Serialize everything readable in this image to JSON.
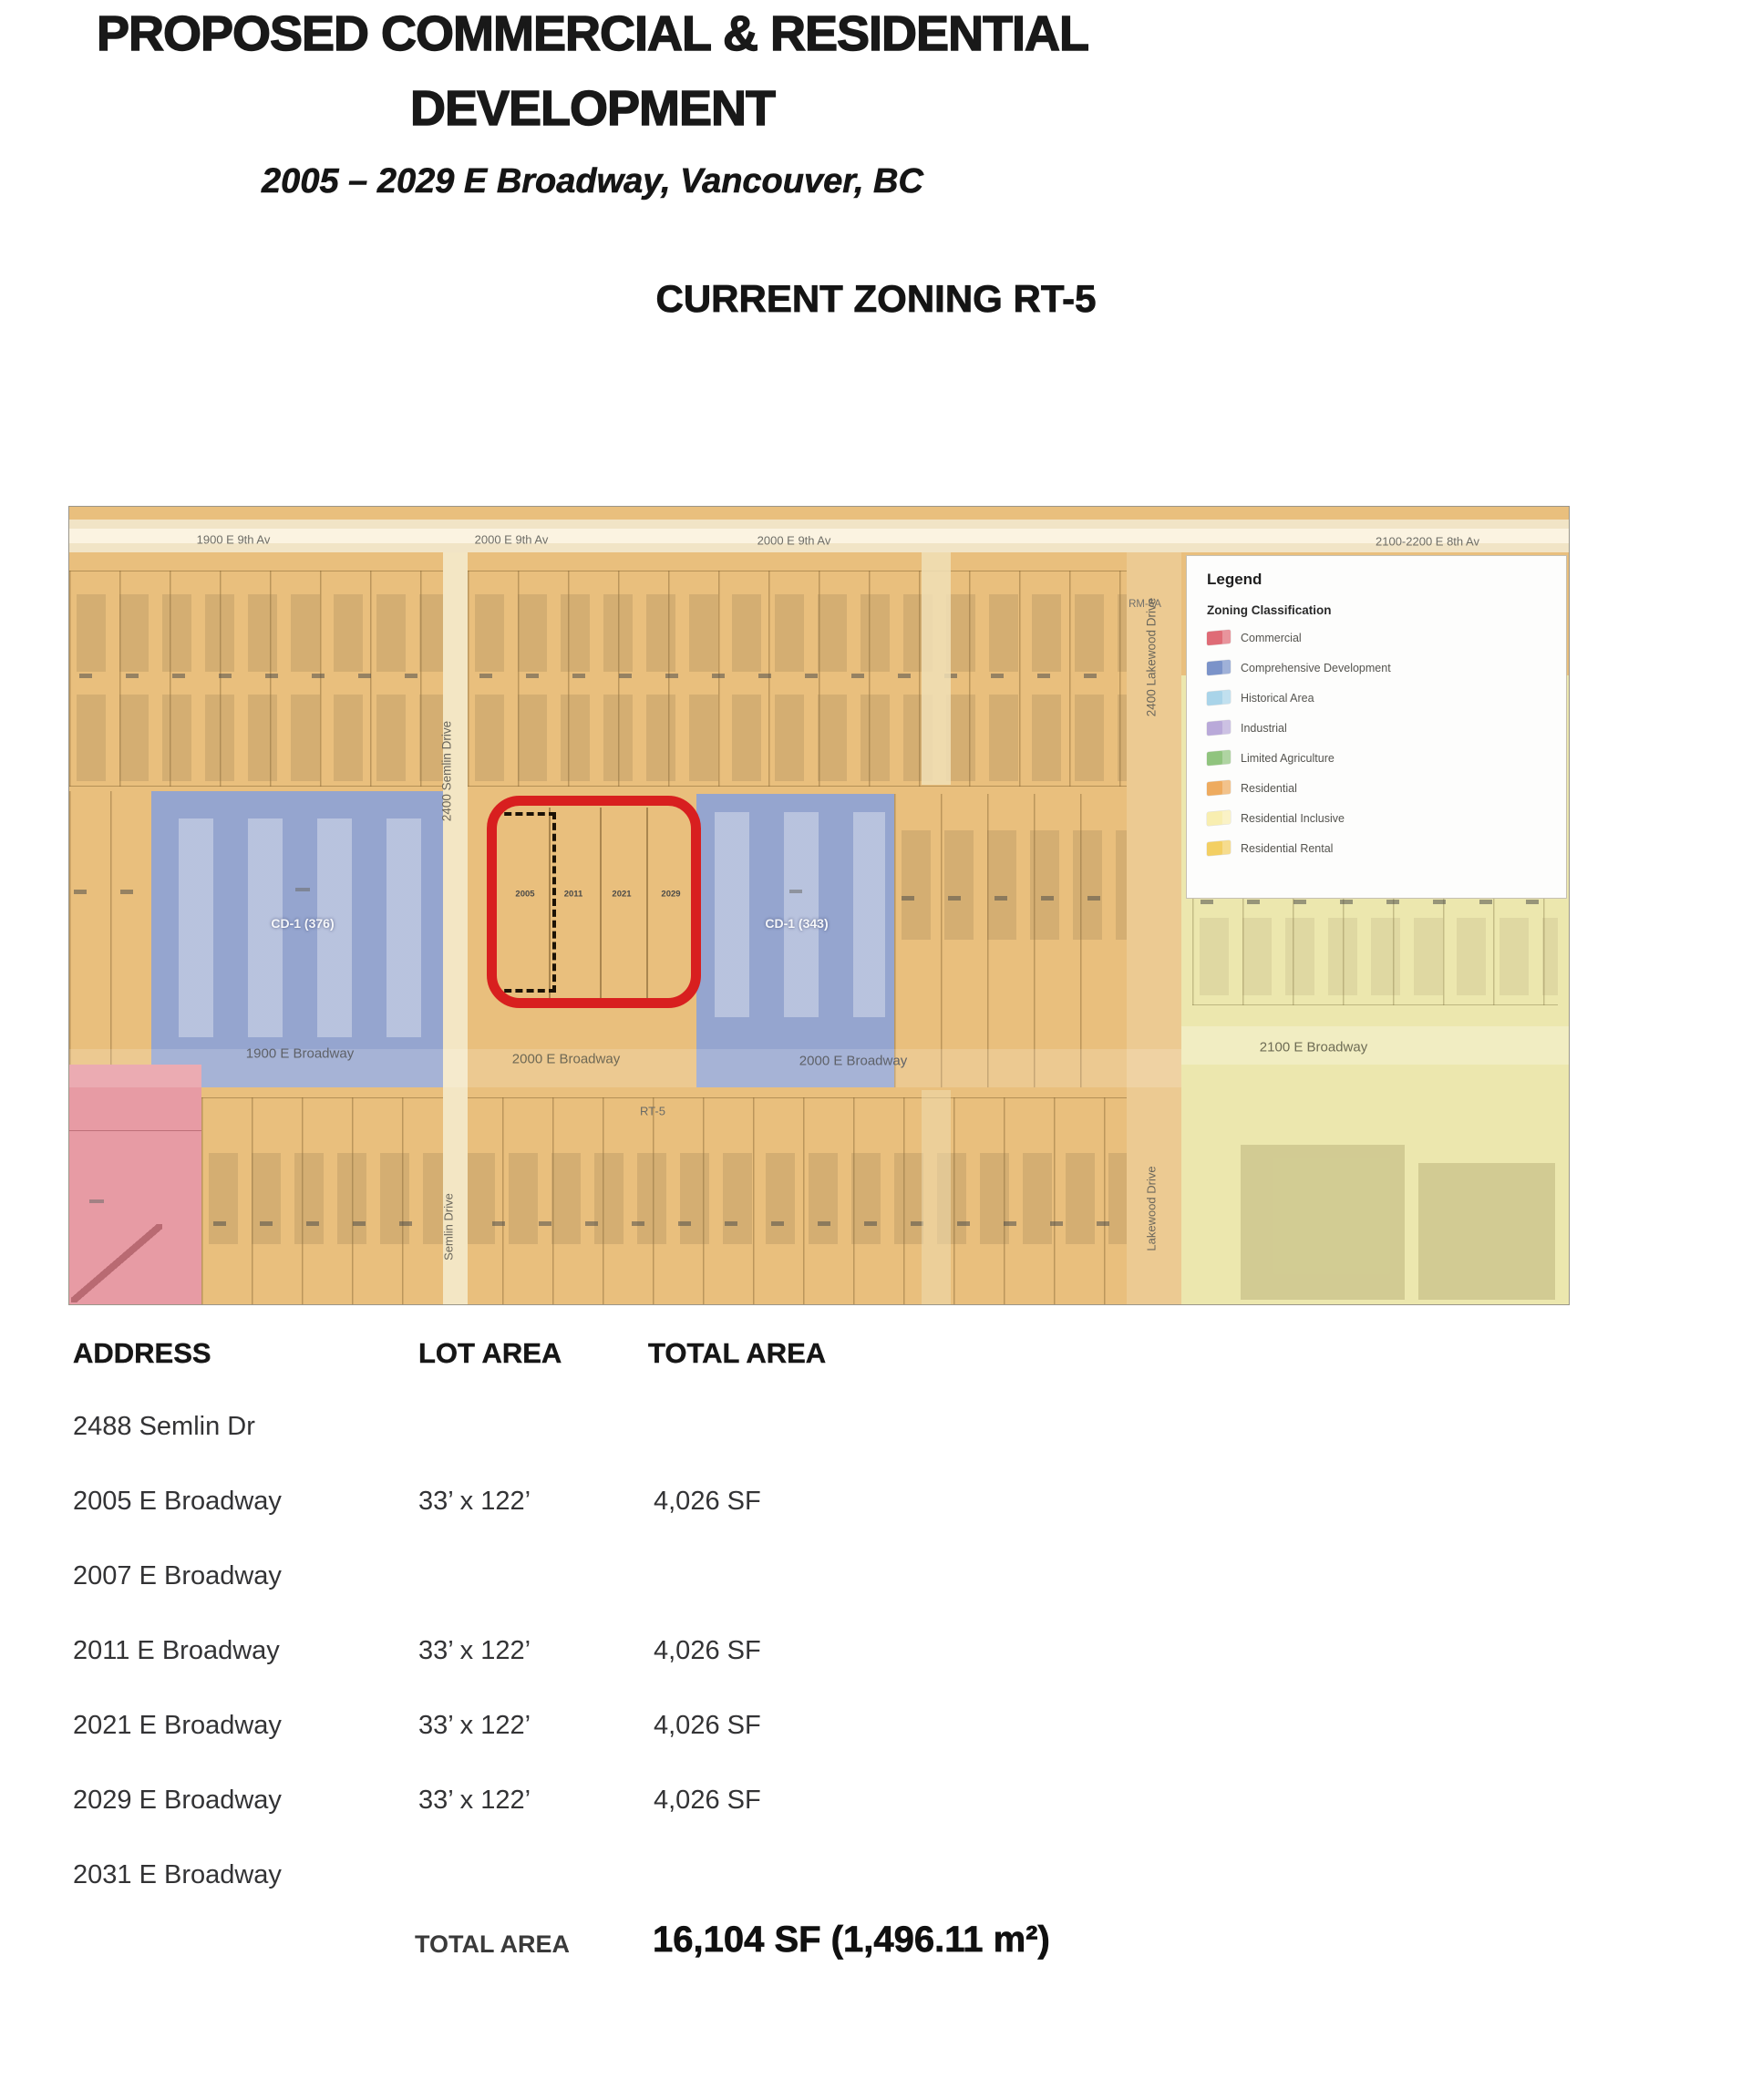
{
  "header": {
    "title_line1": "PROPOSED COMMERCIAL & RESIDENTIAL",
    "title_line2": "DEVELOPMENT",
    "subtitle": "2005 – 2029 E Broadway, Vancouver, BC",
    "section_heading": "CURRENT ZONING RT-5"
  },
  "map": {
    "top_street_labels": [
      "1900 E 9th Av",
      "2000 E 9th Av",
      "2000 E 9th Av",
      "2100-2200 E 8th Av"
    ],
    "broadway_labels": [
      "1900 E Broadway",
      "2000 E Broadway",
      "2000 E Broadway",
      "2100 E Broadway"
    ],
    "vertical_streets": {
      "semlin_upper": "2400 Semlin Drive",
      "semlin_lower": "Semlin Drive",
      "lakewood_upper": "2400 Lakewood Drive",
      "lakewood_lower": "Lakewood Drive"
    },
    "zone_labels": {
      "cd1_west": "CD-1 (376)",
      "cd1_east": "CD-1 (343)",
      "rt5": "RT-5",
      "rm6a": "RM-6A"
    },
    "subject_lots": [
      "2005",
      "2011",
      "2021",
      "2029"
    ],
    "colors": {
      "residential_tan": "#e9bf7d",
      "comprehensive_blue": "#95a5cf",
      "commercial_pink": "#e79ba4",
      "residential_inclusive_yellow": "#ece7ae",
      "street_cream": "#f5e9cd",
      "semlin_cream": "#f3e6c4",
      "lakewood_band": "#ecca92",
      "highlight_red": "#d81f1f"
    },
    "legend": {
      "title": "Legend",
      "subtitle": "Zoning Classification",
      "items": [
        {
          "label": "Commercial",
          "color": "#df6b76"
        },
        {
          "label": "Comprehensive Development",
          "color": "#7b93c9"
        },
        {
          "label": "Historical Area",
          "color": "#a9d4e9"
        },
        {
          "label": "Industrial",
          "color": "#b9a9d9"
        },
        {
          "label": "Limited Agriculture",
          "color": "#90c47e"
        },
        {
          "label": "Residential",
          "color": "#eeab5f"
        },
        {
          "label": "Residential Inclusive",
          "color": "#f8eeb0"
        },
        {
          "label": "Residential Rental",
          "color": "#f3cf63"
        }
      ]
    }
  },
  "table": {
    "headers": [
      "ADDRESS",
      "LOT AREA",
      "TOTAL AREA"
    ],
    "rows": [
      {
        "address": "2488 Semlin Dr",
        "lot_area": "",
        "total_area": ""
      },
      {
        "address": "2005 E Broadway",
        "lot_area": "33’ x 122’",
        "total_area": "4,026 SF"
      },
      {
        "address": "2007 E Broadway",
        "lot_area": "",
        "total_area": ""
      },
      {
        "address": "2011 E Broadway",
        "lot_area": "33’ x 122’",
        "total_area": "4,026 SF"
      },
      {
        "address": "2021 E Broadway",
        "lot_area": "33’ x 122’",
        "total_area": "4,026 SF"
      },
      {
        "address": "2029 E Broadway",
        "lot_area": "33’ x 122’",
        "total_area": "4,026 SF"
      },
      {
        "address": "2031 E Broadway",
        "lot_area": "",
        "total_area": ""
      }
    ],
    "total_label": "TOTAL AREA",
    "total_value": "16,104 SF (1,496.11 m²)"
  }
}
